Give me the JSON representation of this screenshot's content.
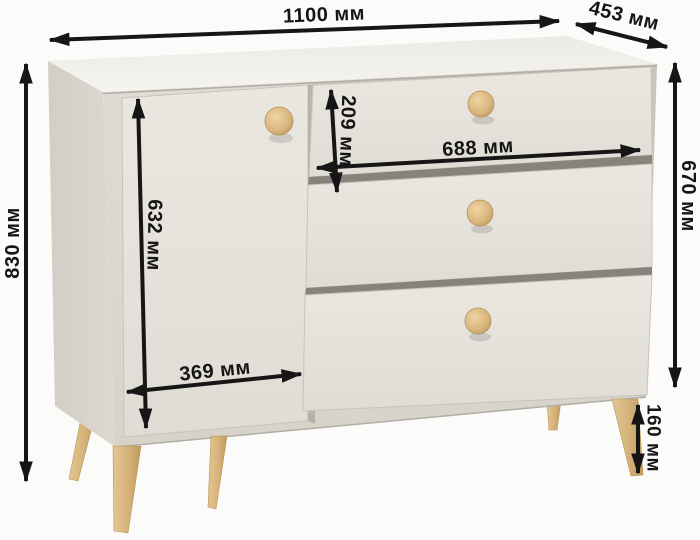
{
  "unit": "мм",
  "product": "комод (dresser with door and 3 drawers)",
  "colors": {
    "background": "#fbfbfa",
    "dimension_line": "#161616",
    "body_front": "#dcd8d0",
    "panel": "#e8e5df",
    "body_top": "#f2f0eb",
    "body_side": "#d6d2c9",
    "gap_shadow": "#87827a",
    "wood": "#d9b67f"
  },
  "dimensions": {
    "width": {
      "label": "1100 мм",
      "value_mm": 1100
    },
    "depth": {
      "label": "453 мм",
      "value_mm": 453
    },
    "height": {
      "label": "830 мм",
      "value_mm": 830
    },
    "drawer_section_height": {
      "label": "670 мм",
      "value_mm": 670
    },
    "door_height": {
      "label": "632 мм",
      "value_mm": 632
    },
    "door_width": {
      "label": "369 мм",
      "value_mm": 369
    },
    "drawer_front_height": {
      "label": "209 мм",
      "value_mm": 209
    },
    "drawer_width": {
      "label": "688 мм",
      "value_mm": 688
    },
    "leg_height": {
      "label": "160 мм",
      "value_mm": 160
    }
  }
}
